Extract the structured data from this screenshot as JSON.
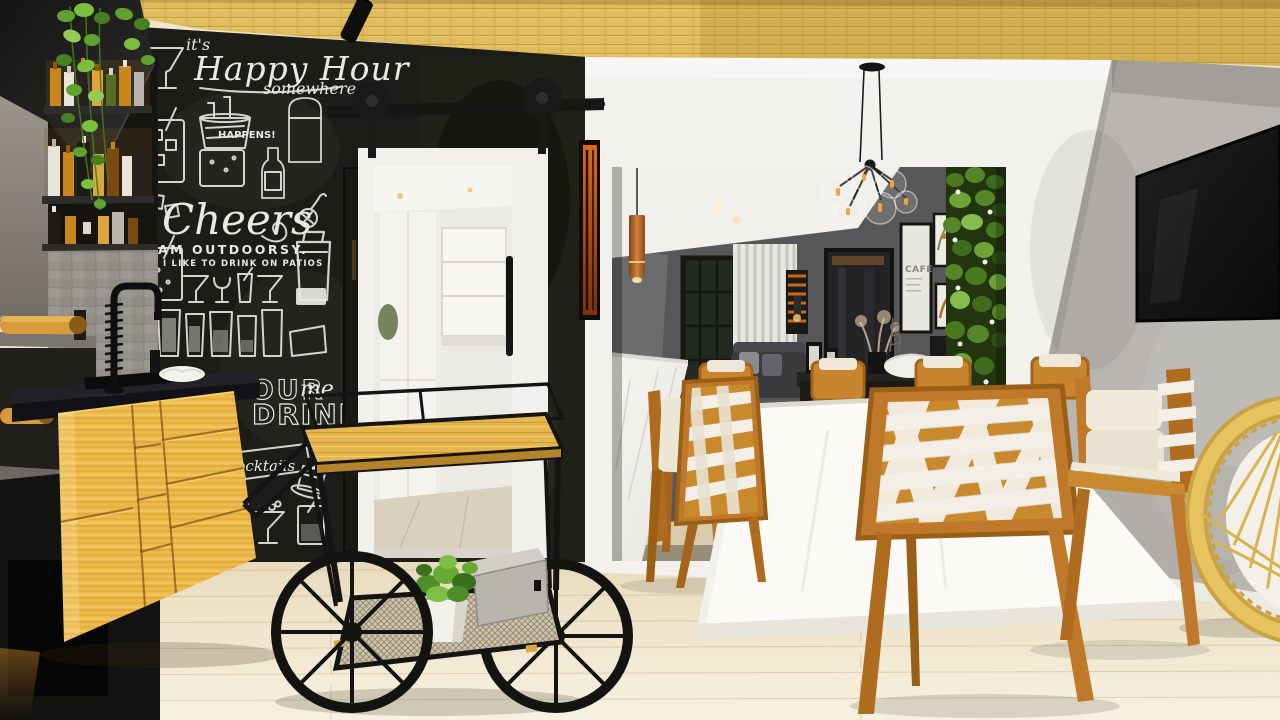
{
  "scene_title": "apartment gourmet bar and dining room render",
  "chalkboard": {
    "its": "it's",
    "happy_hour": "Happy Hour",
    "somewhere": "somewhere",
    "happens": "HAPPENS!",
    "cheers": "Cheers",
    "outdoorsy": "AM OUTDOORSY.",
    "patios": "I LIKE TO DRINK ON PATIOS",
    "pour": "POUR",
    "me": "me",
    "drink": "DRINK",
    "banner": "cocktails"
  },
  "back_room": {
    "poster_title": "CAFÉ"
  },
  "palette": {
    "bamboo_ceiling": "#E0BC5D",
    "chalkboard_wall": "#1C1C18",
    "cabinet_wood": "#ECB94B",
    "chair_wood": "#C0792A",
    "strap_white": "#F3EFE6",
    "floor": "#EFE5CC",
    "right_wall": "#B9B6B1",
    "back_wall": "#5B5B5E",
    "copper_pendant": "#B5692B",
    "plant_green": "#5A9E2F"
  }
}
